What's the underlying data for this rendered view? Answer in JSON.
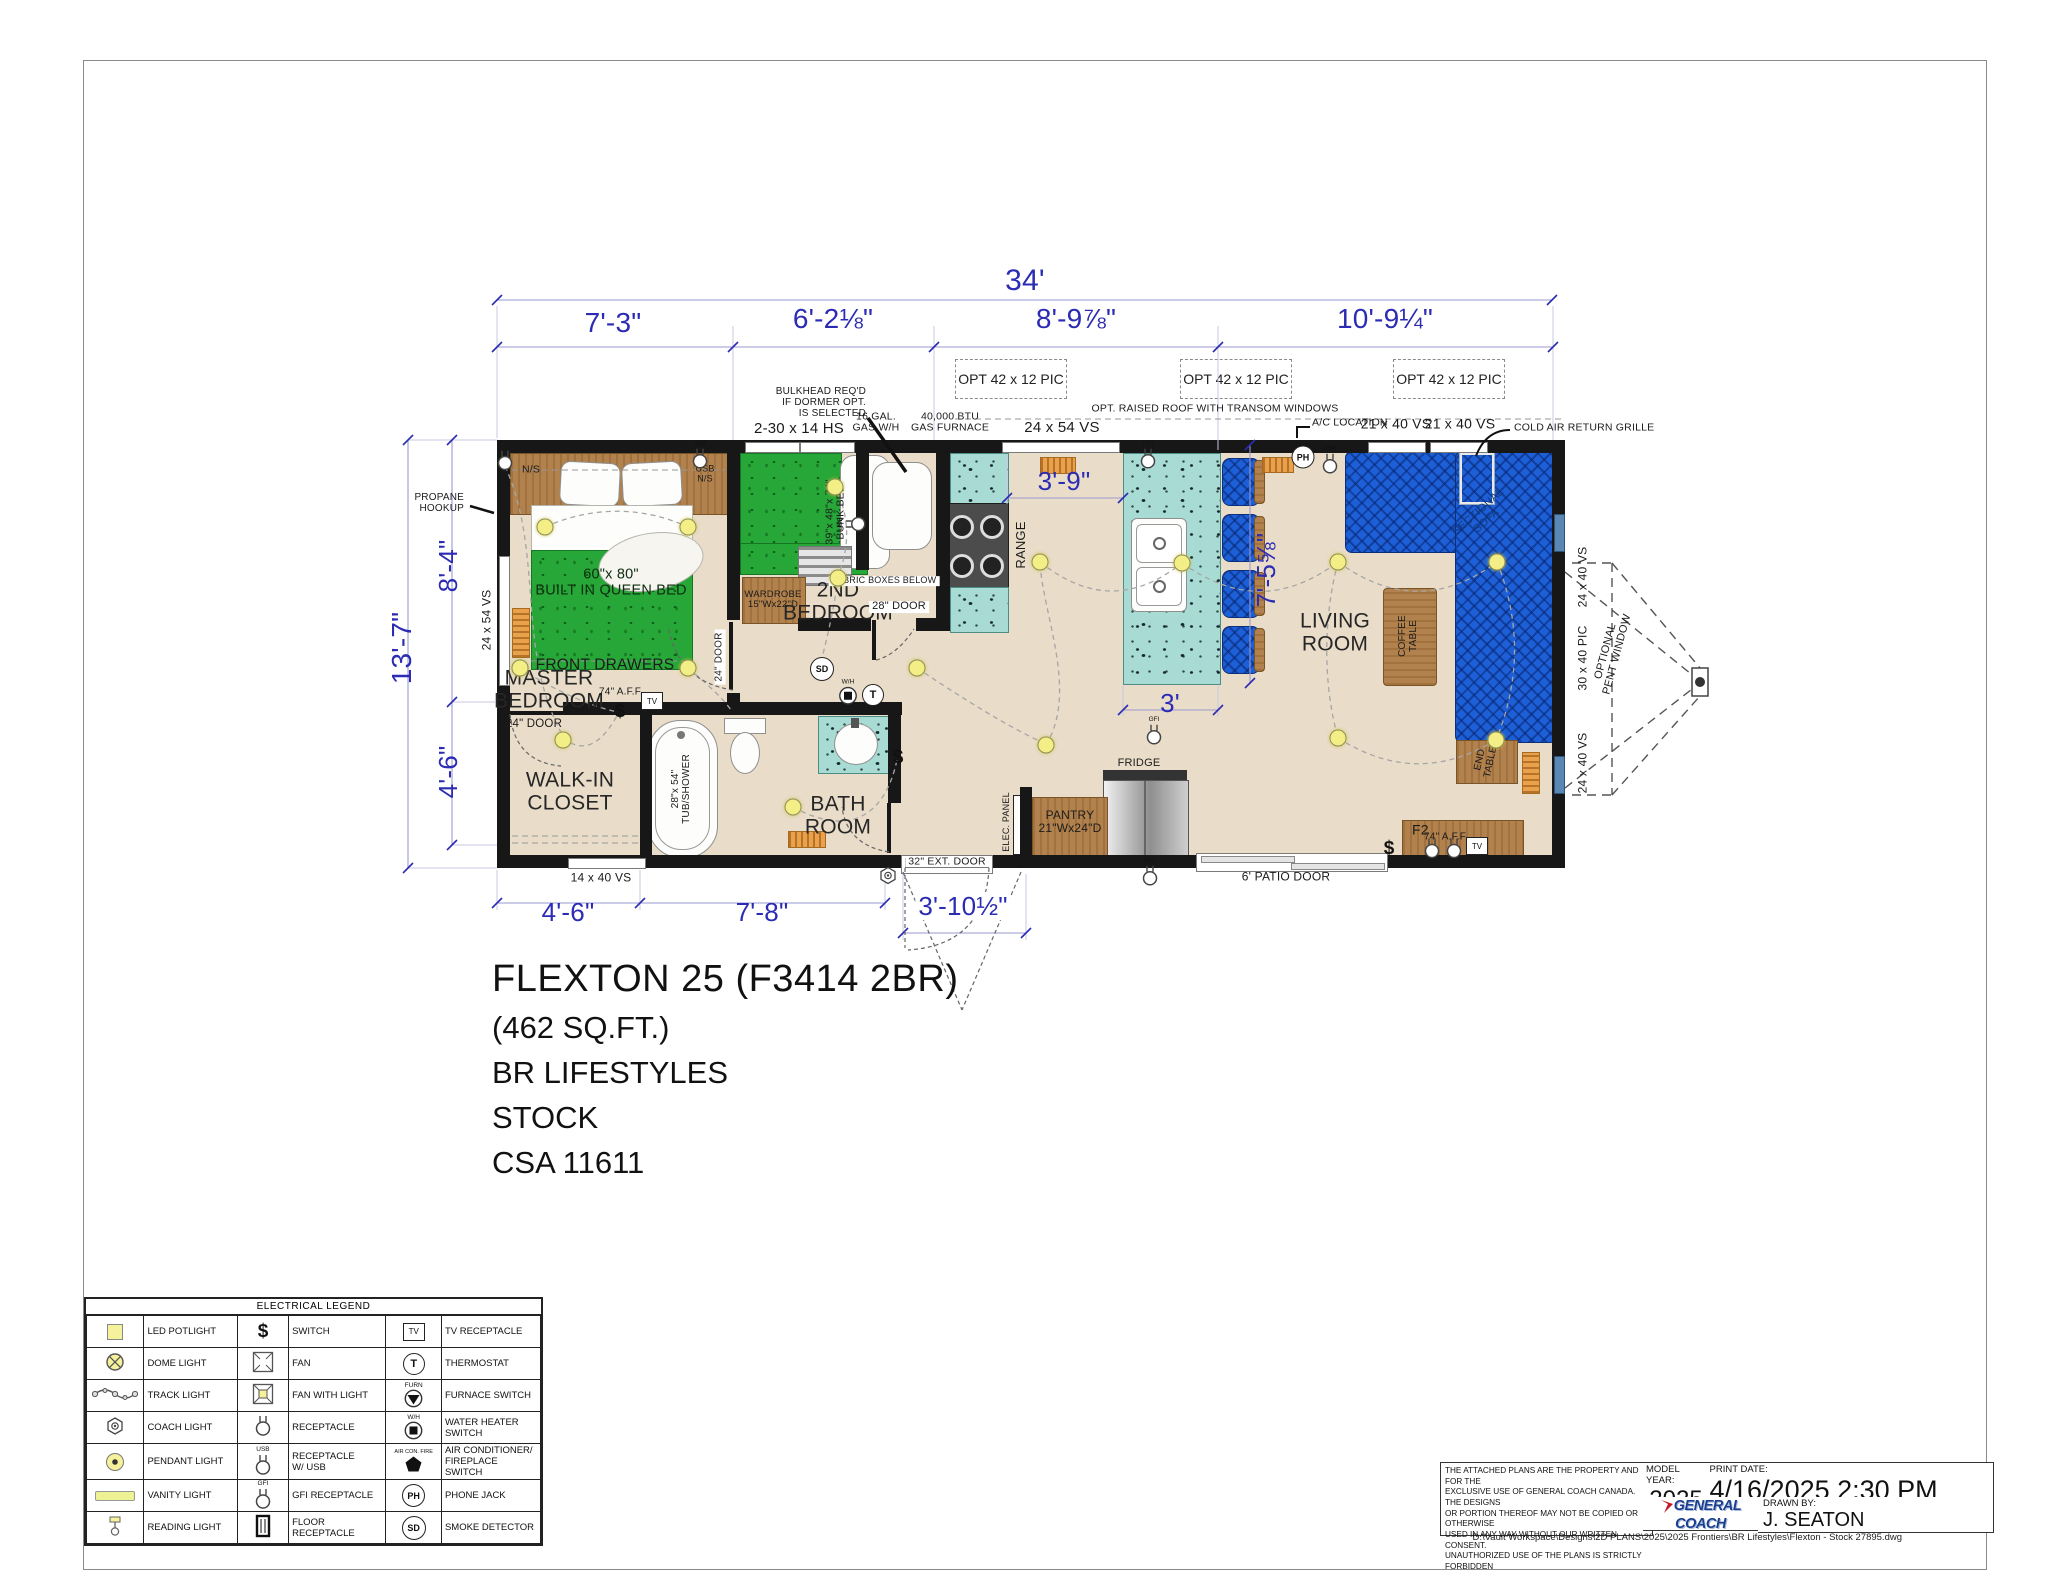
{
  "title_block": {
    "title": "FLEXTON 25 (F3414 2BR)",
    "lines": [
      "(462 SQ.FT.)",
      "BR LIFESTYLES",
      "STOCK",
      "CSA 11611"
    ]
  },
  "glyphs": {
    "tv": "TV",
    "thermostat": "T",
    "phone": "PH",
    "smoke": "SD",
    "furnace": "FURN",
    "water_heater": "W/H",
    "ac_fire": "AIR CON. FIRE",
    "gfi": "GFI",
    "usb": "USB",
    "switch": "$"
  },
  "colors": {
    "dim": "#2b2bb4",
    "lbl": "#1b1b1b",
    "room": "#262626",
    "sofaTxt": "#10387d",
    "bed": "#0e2c10"
  },
  "plan": {
    "opt_boxes": [
      {
        "label": "OPT 42 x 12 PIC",
        "x": 955,
        "y": 359,
        "w": 110,
        "h": 38
      },
      {
        "label": "OPT 42 x 12 PIC",
        "x": 1180,
        "y": 359,
        "w": 110,
        "h": 38
      },
      {
        "label": "OPT 42 x 12 PIC",
        "x": 1393,
        "y": 359,
        "w": 110,
        "h": 38
      }
    ],
    "labels": [
      {
        "t": "34'",
        "x": 1025,
        "y": 281,
        "fs": 30,
        "c": "dim"
      },
      {
        "t": "7'-3\"",
        "x": 613,
        "y": 323,
        "fs": 28,
        "c": "dim"
      },
      {
        "t": "6'-2⅛\"",
        "x": 833,
        "y": 319,
        "fs": 28,
        "c": "dim"
      },
      {
        "t": "8'-9⅞\"",
        "x": 1076,
        "y": 319,
        "fs": 28,
        "c": "dim"
      },
      {
        "t": "10'-9¼\"",
        "x": 1385,
        "y": 319,
        "fs": 28,
        "c": "dim"
      },
      {
        "t": "13'-7\"",
        "x": 402,
        "y": 648,
        "fs": 28,
        "c": "dim",
        "rot": -90
      },
      {
        "t": "8'-4\"",
        "x": 448,
        "y": 566,
        "fs": 26,
        "c": "dim",
        "rot": -90
      },
      {
        "t": "4'-6\"",
        "x": 448,
        "y": 772,
        "fs": 26,
        "c": "dim",
        "rot": -90
      },
      {
        "t": "4'-6\"",
        "x": 568,
        "y": 912,
        "fs": 26,
        "c": "dim"
      },
      {
        "t": "7'-8\"",
        "x": 762,
        "y": 912,
        "fs": 26,
        "c": "dim"
      },
      {
        "t": "3'-10½\"",
        "x": 963,
        "y": 906,
        "fs": 26,
        "c": "dim",
        "bg": 1
      },
      {
        "t": "3'-9\"",
        "x": 1064,
        "y": 481,
        "fs": 26,
        "c": "dim"
      },
      {
        "t": "7'-5⅝\"",
        "x": 1266,
        "y": 570,
        "fs": 26,
        "c": "dim",
        "rot": -90
      },
      {
        "t": "3'",
        "x": 1170,
        "y": 703,
        "fs": 26,
        "c": "dim"
      },
      {
        "t": "2-30 x 14 HS",
        "x": 799,
        "y": 429,
        "fs": 15,
        "c": "lbl"
      },
      {
        "t": "16 GAL.\nGAS W/H",
        "x": 876,
        "y": 423,
        "fs": 10.5,
        "c": "lbl"
      },
      {
        "t": "40,000 BTU\nGAS FURNACE",
        "x": 950,
        "y": 423,
        "fs": 10.5,
        "c": "lbl"
      },
      {
        "t": "24 x 54 VS",
        "x": 1062,
        "y": 428,
        "fs": 15,
        "c": "lbl"
      },
      {
        "t": "OPT. RAISED ROOF WITH TRANSOM WINDOWS",
        "x": 1215,
        "y": 409,
        "fs": 10.5,
        "c": "lbl"
      },
      {
        "t": "A/C LOCATION",
        "x": 1312,
        "y": 423,
        "fs": 10.5,
        "c": "lbl",
        "al": "l"
      },
      {
        "t": "21 x 40 VS",
        "x": 1396,
        "y": 424,
        "fs": 14,
        "c": "lbl"
      },
      {
        "t": "21 x 40 VS",
        "x": 1460,
        "y": 424,
        "fs": 14,
        "c": "lbl"
      },
      {
        "t": "COLD AIR RETURN GRILLE",
        "x": 1514,
        "y": 428,
        "fs": 10.5,
        "c": "lbl",
        "al": "l"
      },
      {
        "t": "BULKHEAD REQ'D\nIF DORMER OPT.\nIS SELECTED",
        "x": 866,
        "y": 403,
        "fs": 10,
        "c": "lbl",
        "al": "r"
      },
      {
        "t": "PROPANE\nHOOKUP",
        "x": 464,
        "y": 504,
        "fs": 10,
        "c": "lbl",
        "al": "r"
      },
      {
        "t": "N/S",
        "x": 531,
        "y": 470,
        "fs": 10.5,
        "c": "lbl"
      },
      {
        "t": "USB\nN/S",
        "x": 705,
        "y": 474,
        "fs": 9,
        "c": "lbl"
      },
      {
        "t": "60\"x 80\"\nBUILT IN QUEEN BED",
        "x": 611,
        "y": 583,
        "fs": 14.5,
        "c": "bed"
      },
      {
        "t": "FRONT DRAWERS",
        "x": 605,
        "y": 666,
        "fs": 15.5,
        "c": "lbl"
      },
      {
        "t": "MASTER\nBEDROOM",
        "x": 549,
        "y": 690,
        "fs": 21,
        "c": "room"
      },
      {
        "t": "24 x 54 VS",
        "x": 487,
        "y": 620,
        "fs": 12,
        "c": "lbl",
        "rot": -90
      },
      {
        "t": "74\" A.F.F.",
        "x": 621,
        "y": 693,
        "fs": 10,
        "c": "lbl"
      },
      {
        "t": "24\" DOOR",
        "x": 534,
        "y": 724,
        "fs": 11.5,
        "c": "lbl"
      },
      {
        "t": "24\" DOOR",
        "x": 720,
        "y": 657,
        "fs": 10,
        "c": "lbl",
        "rot": -90,
        "bg": 1
      },
      {
        "t": "WALK-IN\nCLOSET",
        "x": 570,
        "y": 792,
        "fs": 21,
        "c": "room"
      },
      {
        "t": "28\"x 54\"\nTUB/SHOWER",
        "x": 682,
        "y": 789,
        "fs": 10,
        "c": "lbl",
        "rot": -90
      },
      {
        "t": "14 x 40 VS",
        "x": 601,
        "y": 878,
        "fs": 12,
        "c": "lbl",
        "bg": 1
      },
      {
        "t": "39\"x 48\"x 74\"\nBUNK BED",
        "x": 836,
        "y": 512,
        "fs": 10.5,
        "c": "lbl",
        "rot": -90
      },
      {
        "t": "WARDROBE\n15\"Wx22\"D",
        "x": 773,
        "y": 600,
        "fs": 9.5,
        "c": "lbl"
      },
      {
        "t": "2ND\nBEDROOM",
        "x": 838,
        "y": 602,
        "fs": 21,
        "c": "room"
      },
      {
        "t": "FABRIC BOXES BELOW",
        "x": 884,
        "y": 581,
        "fs": 9,
        "c": "lbl",
        "bg": 1
      },
      {
        "t": "28\" DOOR",
        "x": 899,
        "y": 607,
        "fs": 11,
        "c": "lbl",
        "bg": 1
      },
      {
        "t": "BATH\nROOM",
        "x": 838,
        "y": 816,
        "fs": 21,
        "c": "room"
      },
      {
        "t": "RANGE",
        "x": 1021,
        "y": 545,
        "fs": 13,
        "c": "lbl",
        "rot": -90
      },
      {
        "t": "LIVING\nROOM",
        "x": 1335,
        "y": 633,
        "fs": 21,
        "c": "room"
      },
      {
        "t": "COFFEE\nTABLE",
        "x": 1409,
        "y": 636,
        "fs": 10,
        "c": "lbl",
        "rot": -90
      },
      {
        "t": "END\nTABLE",
        "x": 1486,
        "y": 761,
        "fs": 10,
        "c": "lbl",
        "rot": -78
      },
      {
        "t": "F2",
        "x": 1412,
        "y": 830,
        "fs": 14,
        "c": "lbl",
        "al": "l"
      },
      {
        "t": "74\" A.F.F.",
        "x": 1446,
        "y": 838,
        "fs": 10,
        "c": "lbl"
      },
      {
        "t": "SECTIONAL\nSOFA",
        "x": 1483,
        "y": 517,
        "fs": 11,
        "c": "sofaTxt",
        "rot": -42
      },
      {
        "t": "FRIDGE",
        "x": 1139,
        "y": 764,
        "fs": 11,
        "c": "lbl"
      },
      {
        "t": "PANTRY\n21\"Wx24\"D",
        "x": 1070,
        "y": 822,
        "fs": 12,
        "c": "lbl"
      },
      {
        "t": "ELEC. PANEL",
        "x": 1007,
        "y": 822,
        "fs": 9,
        "c": "lbl",
        "rot": -90
      },
      {
        "t": "32\" EXT. DOOR",
        "x": 947,
        "y": 862,
        "fs": 10.5,
        "c": "lbl",
        "bg": 1
      },
      {
        "t": "6' PATIO DOOR",
        "x": 1286,
        "y": 877,
        "fs": 12,
        "c": "lbl"
      },
      {
        "t": "24 x 40 VS",
        "x": 1583,
        "y": 577,
        "fs": 12,
        "c": "lbl",
        "rot": -90
      },
      {
        "t": "30 x 40 PIC",
        "x": 1583,
        "y": 658,
        "fs": 12,
        "c": "lbl",
        "rot": -90
      },
      {
        "t": "24 x 40 VS",
        "x": 1583,
        "y": 763,
        "fs": 12,
        "c": "lbl",
        "rot": -90
      },
      {
        "t": "OPTIONAL\nPENT WINDOW",
        "x": 1612,
        "y": 653,
        "fs": 11,
        "c": "lbl",
        "rot": -75
      }
    ],
    "lights": [
      [
        545,
        527
      ],
      [
        688,
        527
      ],
      [
        520,
        668
      ],
      [
        688,
        668
      ],
      [
        563,
        740
      ],
      [
        835,
        487
      ],
      [
        838,
        578
      ],
      [
        917,
        668
      ],
      [
        793,
        807
      ],
      [
        1046,
        745
      ],
      [
        1040,
        562
      ],
      [
        1182,
        563
      ],
      [
        1338,
        562
      ],
      [
        1497,
        562
      ],
      [
        1338,
        738
      ],
      [
        1496,
        740
      ]
    ],
    "symbols": [
      {
        "k": "smoke-detector",
        "x": 822,
        "y": 669
      },
      {
        "k": "thermostat",
        "x": 873,
        "y": 695
      },
      {
        "k": "wh-switch",
        "x": 848,
        "y": 692
      },
      {
        "k": "phone-jack",
        "x": 1303,
        "y": 457
      },
      {
        "k": "receptacle-usb",
        "x": 1330,
        "y": 460
      },
      {
        "k": "receptacle",
        "x": 505,
        "y": 463
      },
      {
        "k": "receptacle-usb",
        "x": 700,
        "y": 455
      },
      {
        "k": "receptacle-usb",
        "x": 852,
        "y": 524,
        "r": -90
      },
      {
        "k": "gfi-receptacle",
        "x": 1148,
        "y": 455
      },
      {
        "k": "gfi-receptacle",
        "x": 1154,
        "y": 731
      },
      {
        "k": "gfi-receptacle",
        "x": 1150,
        "y": 872
      },
      {
        "k": "receptacle",
        "x": 1432,
        "y": 851
      },
      {
        "k": "receptacle",
        "x": 1454,
        "y": 851
      },
      {
        "k": "tv-receptacle",
        "x": 652,
        "y": 701
      },
      {
        "k": "tv-receptacle",
        "x": 1477,
        "y": 846
      },
      {
        "k": "switch",
        "x": 620,
        "y": 712
      },
      {
        "k": "switch",
        "x": 898,
        "y": 758
      },
      {
        "k": "switch",
        "x": 1389,
        "y": 849
      },
      {
        "k": "coach-light",
        "x": 888,
        "y": 878
      }
    ]
  },
  "legend": {
    "title": "ELECTRICAL LEGEND",
    "rows": [
      [
        {
          "icon": "led-potlight",
          "label": "LED POTLIGHT"
        },
        {
          "icon": "switch",
          "label": "SWITCH"
        },
        {
          "icon": "tv-receptacle",
          "label": "TV RECEPTACLE"
        }
      ],
      [
        {
          "icon": "dome-light",
          "label": "DOME LIGHT"
        },
        {
          "icon": "fan",
          "label": "FAN"
        },
        {
          "icon": "thermostat",
          "label": "THERMOSTAT"
        }
      ],
      [
        {
          "icon": "track-light",
          "label": "TRACK LIGHT"
        },
        {
          "icon": "fan-light",
          "label": "FAN WITH LIGHT"
        },
        {
          "icon": "furnace-switch",
          "label": "FURNACE SWITCH"
        }
      ],
      [
        {
          "icon": "coach-light",
          "label": "COACH LIGHT"
        },
        {
          "icon": "receptacle",
          "label": "RECEPTACLE"
        },
        {
          "icon": "wh-switch",
          "label": "WATER HEATER\nSWITCH"
        }
      ],
      [
        {
          "icon": "pendant-light",
          "label": "PENDANT LIGHT"
        },
        {
          "icon": "receptacle-usb",
          "label": "RECEPTACLE\nW/ USB"
        },
        {
          "icon": "ac-fire-switch",
          "label": "AIR CONDITIONER/\nFIREPLACE SWITCH"
        }
      ],
      [
        {
          "icon": "vanity-light",
          "label": "VANITY LIGHT"
        },
        {
          "icon": "gfi-receptacle",
          "label": "GFI RECEPTACLE"
        },
        {
          "icon": "phone-jack",
          "label": "PHONE JACK"
        }
      ],
      [
        {
          "icon": "reading-light",
          "label": "READING LIGHT"
        },
        {
          "icon": "floor-receptacle",
          "label": "FLOOR RECEPTACLE"
        },
        {
          "icon": "smoke-detector",
          "label": "SMOKE DETECTOR"
        }
      ]
    ]
  },
  "footer": {
    "disclaimer": "THE ATTACHED PLANS ARE THE PROPERTY AND FOR THE\nEXCLUSIVE USE OF GENERAL COACH CANADA. THE DESIGNS\nOR PORTION THEREOF MAY NOT BE COPIED OR OTHERWISE\nUSED IN ANY WAY WITHOUT OUR WRITTEN CONSENT.\nUNAUTHORIZED USE OF THE PLANS IS STRICTLY FORBIDDEN",
    "model_year_label": "MODEL YEAR:",
    "model_year": "2025",
    "print_date_label": "PRINT DATE:",
    "print_date": "4/16/2025 2:30 PM",
    "drawn_by_label": "DRAWN BY:",
    "drawn_by": "J. SEATON",
    "logo_main": "GENERAL COACH",
    "logo_sub": "C A N A D A",
    "file_path": "D:\\Vault Workspace\\Designs\\2D PLANS\\2025\\2025 Frontiers\\BR Lifestyles\\Flexton - Stock 27895.dwg"
  }
}
